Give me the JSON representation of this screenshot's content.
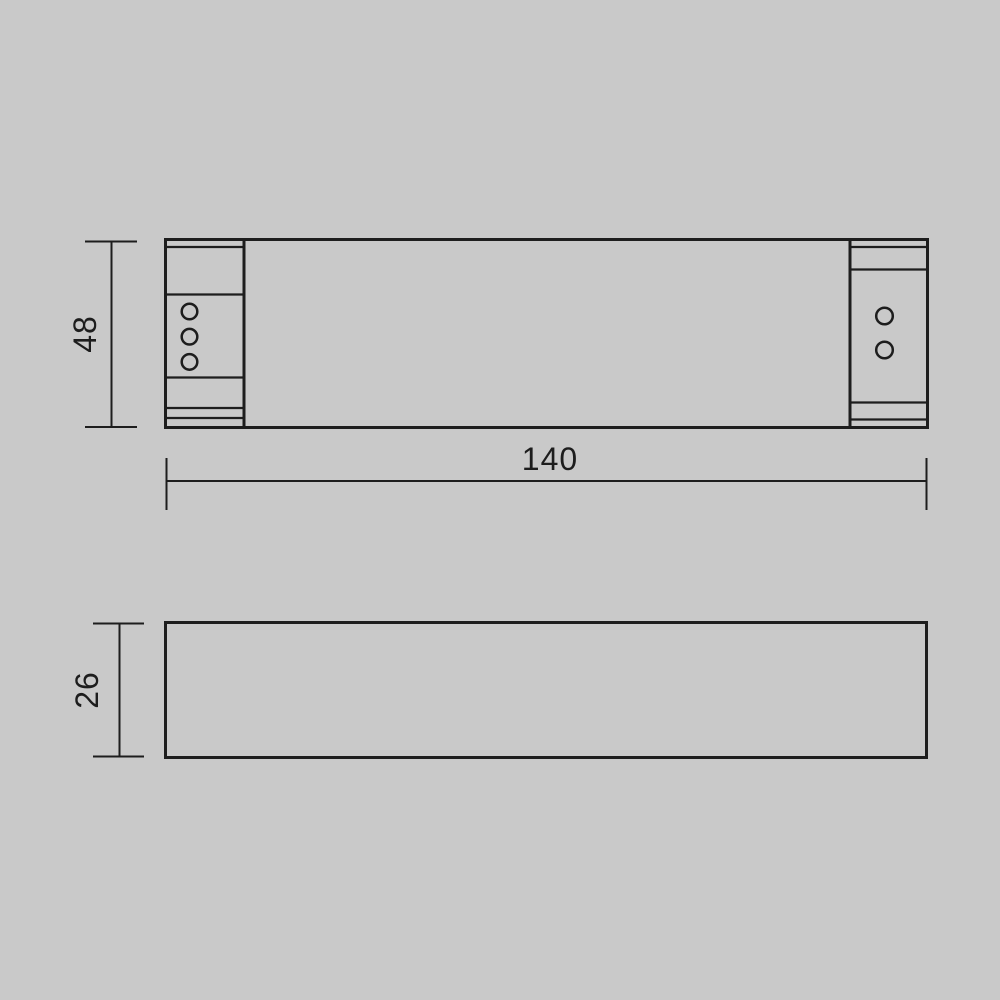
{
  "colors": {
    "background": "#c9c9c9",
    "line": "#1d1d1d"
  },
  "dimensions": {
    "top_view_height": "48",
    "top_view_width": "140",
    "side_view_height": "26"
  },
  "terminals": {
    "left_count": 3,
    "right_count": 2
  }
}
